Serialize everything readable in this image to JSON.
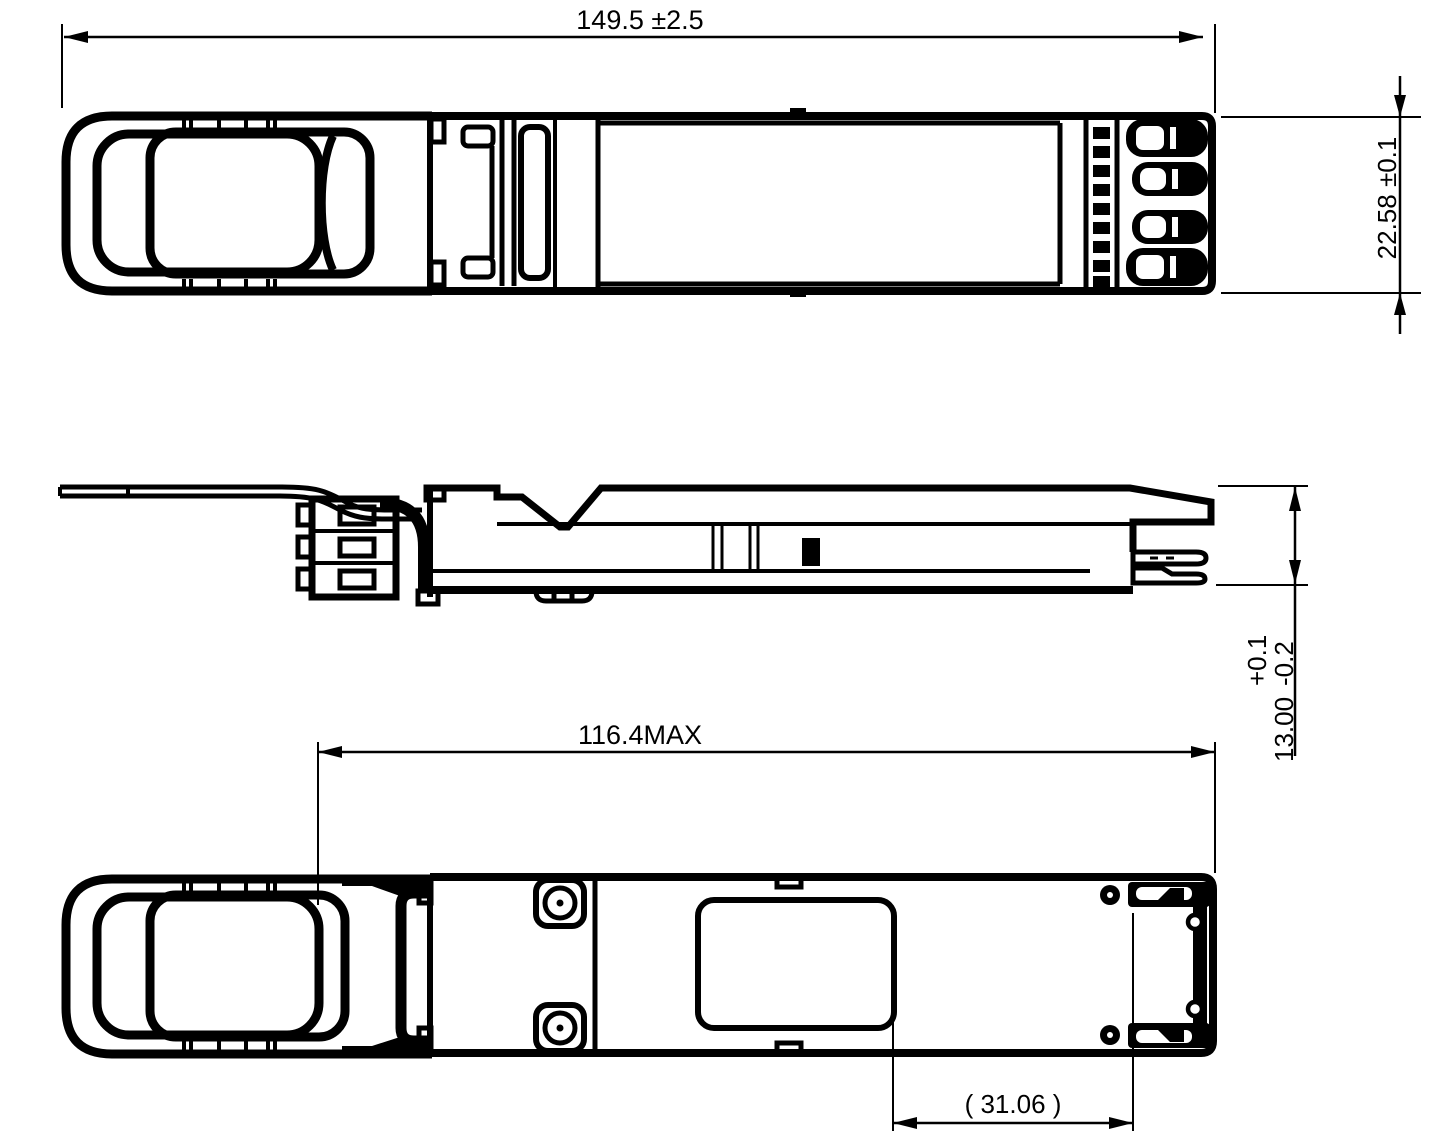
{
  "drawing": {
    "background_color": "#ffffff",
    "line_color": "#000000",
    "dimensions": {
      "overall_length": {
        "label": "149.5 ±2.5"
      },
      "body_height": {
        "label": "22.58 ±0.1"
      },
      "housing_length": {
        "label": "116.4MAX"
      },
      "reference_offset": {
        "label": "( 31.06 )"
      },
      "thickness": {
        "value": "13.00",
        "tolerance_upper": "+0.1",
        "tolerance_lower": "-0.2"
      }
    }
  }
}
